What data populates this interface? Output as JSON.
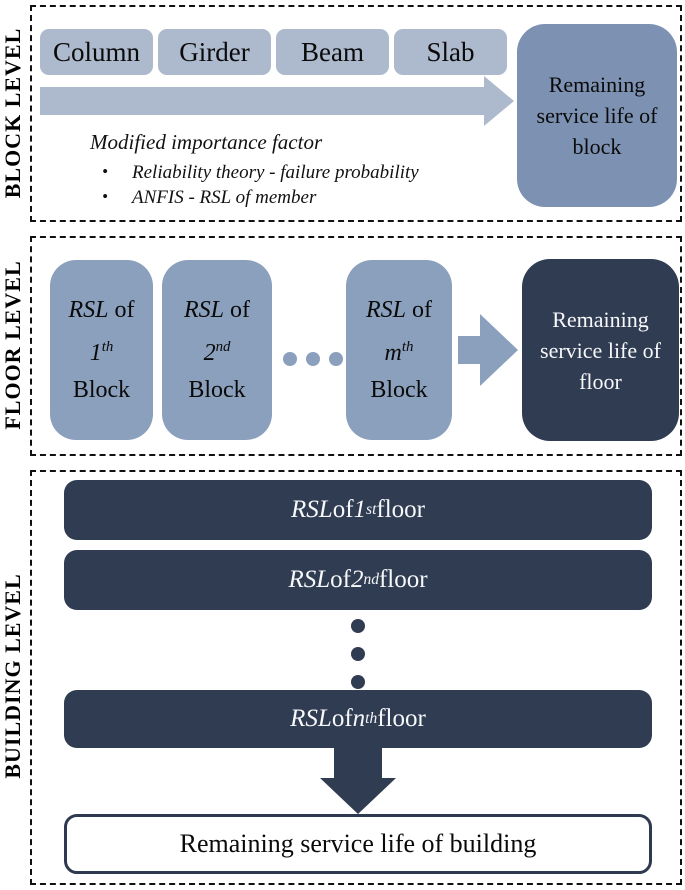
{
  "palette": {
    "light_blue": "#adb9cc",
    "medium_blue": "#8ba0bc",
    "steel_blue": "#7d92b3",
    "dark_navy": "#303c52",
    "dash_border": "#111111"
  },
  "block_level": {
    "label": "BLOCK LEVEL",
    "members": [
      "Column",
      "Girder",
      "Beam",
      "Slab"
    ],
    "importance_title": "Modified importance factor",
    "bullet_char": "•",
    "bullets": [
      "Reliability theory - failure probability",
      "ANFIS - RSL of member"
    ],
    "result": "Remaining service life of block"
  },
  "floor_level": {
    "label": "FLOOR LEVEL",
    "blocks": [
      {
        "rsl": "RSL",
        "of": " of",
        "ord": "1",
        "sup": "th",
        "noun": "Block"
      },
      {
        "rsl": "RSL",
        "of": " of",
        "ord": "2",
        "sup": "nd",
        "noun": "Block"
      },
      {
        "rsl": "RSL",
        "of": " of",
        "ord": "m",
        "sup": "th",
        "noun": "Block"
      }
    ],
    "result": "Remaining service life of floor"
  },
  "building_level": {
    "label": "BUILDING LEVEL",
    "floors": [
      {
        "rsl": "RSL",
        "of": " of ",
        "ord": "1",
        "sup": "st",
        "tail": " floor"
      },
      {
        "rsl": "RSL",
        "of": " of ",
        "ord": "2",
        "sup": "nd",
        "tail": " floor"
      },
      {
        "rsl": "RSL",
        "of": " of ",
        "ord": "n",
        "sup": "th",
        "tail": " floor"
      }
    ],
    "result": "Remaining service life of building"
  }
}
